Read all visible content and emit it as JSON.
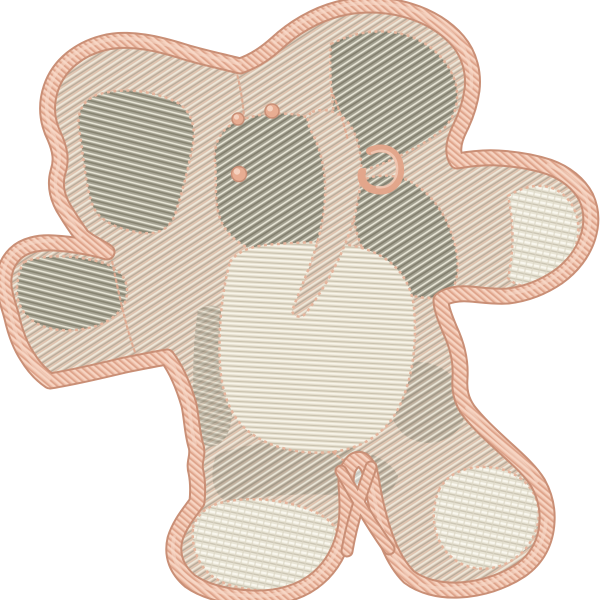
{
  "image": {
    "description": "Machine embroidery design of a toy elephant seen from the front, with two large floppy ears, outstretched stubby arms, a trunk hanging down the face, a stitched belly patch and two feet, filled with cream and taupe thread textures and bordered by a thick peach satin-stitch outline on a white background",
    "subject": "toy elephant embroidery applique",
    "background_color": "#ffffff",
    "colors": {
      "satin_outline": "#edbfa9",
      "satin_shadow": "#c98f76",
      "satin_highlight": "#f8dbca",
      "fill_tan": "#d8c9b8",
      "fill_taupe_dark": "#a3a090",
      "fill_cream": "#e8e4d5",
      "belly_cream": "#e5decd",
      "knot_pink": "#e8ad92",
      "seam_stitch_pink": "#dfa98f"
    }
  }
}
